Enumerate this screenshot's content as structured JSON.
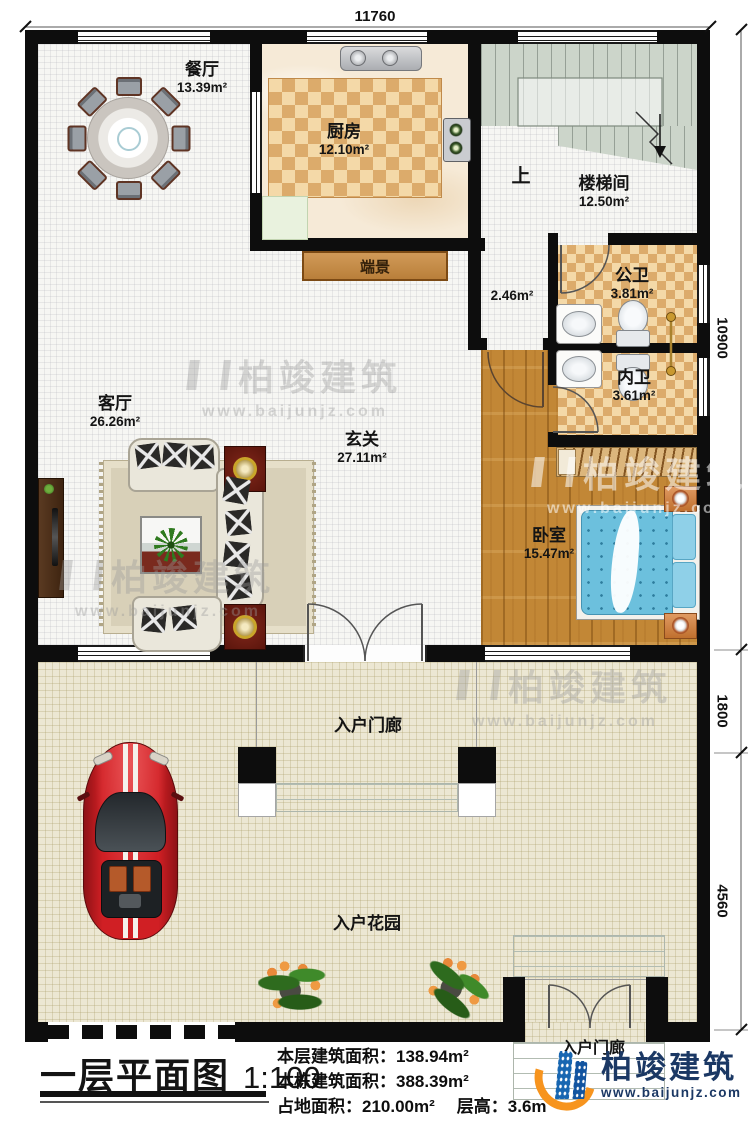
{
  "title_block": {
    "plan_title": "一层平面图",
    "plan_scale": "1:100"
  },
  "stats": {
    "line1_label": "本层建筑面积：",
    "line1_value": "138.94m²",
    "line2_label": "本栋建筑面积：",
    "line2_value": "388.39m²",
    "line3a_label": "占地面积：",
    "line3a_value": "210.00m²",
    "line3b_label": "层高：",
    "line3b_value": "3.6m"
  },
  "dimensions": {
    "top": "11760",
    "right_upper": "10900",
    "right_middle": "1800",
    "right_lower": "4560"
  },
  "rooms": {
    "dining": {
      "name": "餐厅",
      "area": "13.39m²"
    },
    "kitchen": {
      "name": "厨房",
      "area": "12.10m²"
    },
    "stair": {
      "name": "楼梯间",
      "area": "12.50m²"
    },
    "public_bath": {
      "name": "公卫",
      "area": "3.81m²"
    },
    "private_bath": {
      "name": "内卫",
      "area": "3.61m²"
    },
    "living": {
      "name": "客厅",
      "area": "26.26m²"
    },
    "foyer": {
      "name": "玄关",
      "area": "27.11m²"
    },
    "bedroom": {
      "name": "卧室",
      "area": "15.47m²"
    },
    "porch": {
      "name": "入户门廊"
    },
    "garden": {
      "name": "入户花园"
    },
    "porch2": {
      "name": "入户门廊"
    }
  },
  "labels": {
    "up": "上",
    "hall_area": "2.46m²",
    "console": "端景"
  },
  "branding": {
    "company": "柏竣建筑",
    "website": "www.baijunjz.com"
  },
  "colors": {
    "wall": "#0d0d0d",
    "brand_navy": "#1b3864",
    "logo_blue": "#1766b1",
    "logo_orange": "#f7941e",
    "bed_blue": "#6cc0dd",
    "car_red": "#d01f24",
    "stair_green": "#ccd5ca",
    "tile_dark": "#dcab6b",
    "tile_light": "#f4d9a8"
  }
}
